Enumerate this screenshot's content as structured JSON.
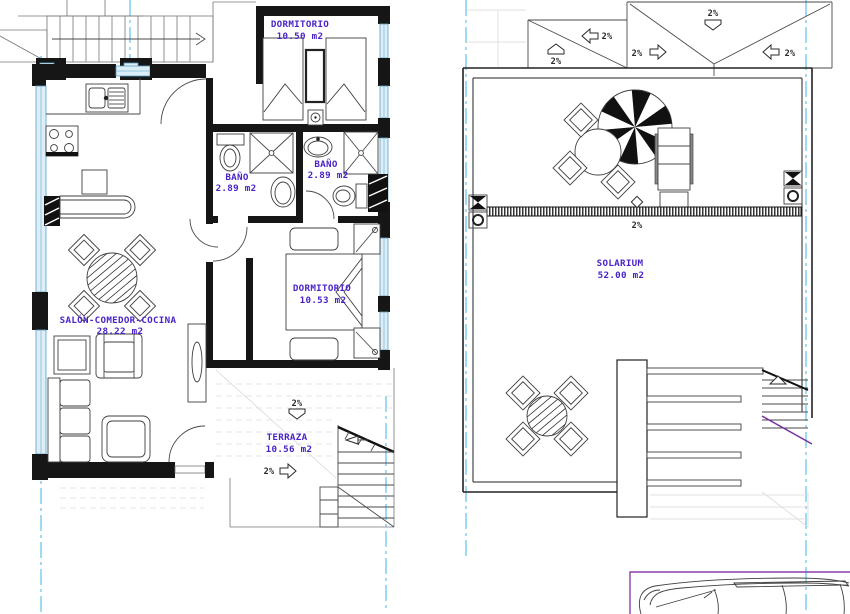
{
  "drawing": {
    "kind": "architectural floor plan, two levels side by side",
    "colors": {
      "room_label": "#4a23c8",
      "wall": "#161616",
      "window_glazing": "#5f9fc0",
      "centerline": "#3db4e4",
      "parking_outline": "#8b3fa8",
      "slope_label": "#2a2a2a"
    }
  },
  "floor_plan": {
    "rooms": [
      {
        "id": "dormitorio-1",
        "label": "DORMITORIO",
        "area": "10.50 m2"
      },
      {
        "id": "bano-1",
        "label": "BAÑO",
        "area": "2.89 m2"
      },
      {
        "id": "bano-2",
        "label": "BAÑO",
        "area": "2.89 m2"
      },
      {
        "id": "dormitorio-2",
        "label": "DORMITORIO",
        "area": "10.53 m2"
      },
      {
        "id": "salon-comedor-cocina",
        "label": "SALÓN-COMEDOR-COCINA",
        "area": "28.22 m2"
      },
      {
        "id": "terraza",
        "label": "TERRAZA",
        "area": "10.56 m2"
      }
    ],
    "slope_labels": [
      "2%",
      "2%"
    ]
  },
  "solarium_plan": {
    "rooms": [
      {
        "id": "solarium",
        "label": "SOLARIUM",
        "area": "52.00 m2"
      }
    ],
    "roof_slope_labels": [
      "2%",
      "2%",
      "2%",
      "2%",
      "2%"
    ],
    "channel_slope_label": "2%"
  }
}
